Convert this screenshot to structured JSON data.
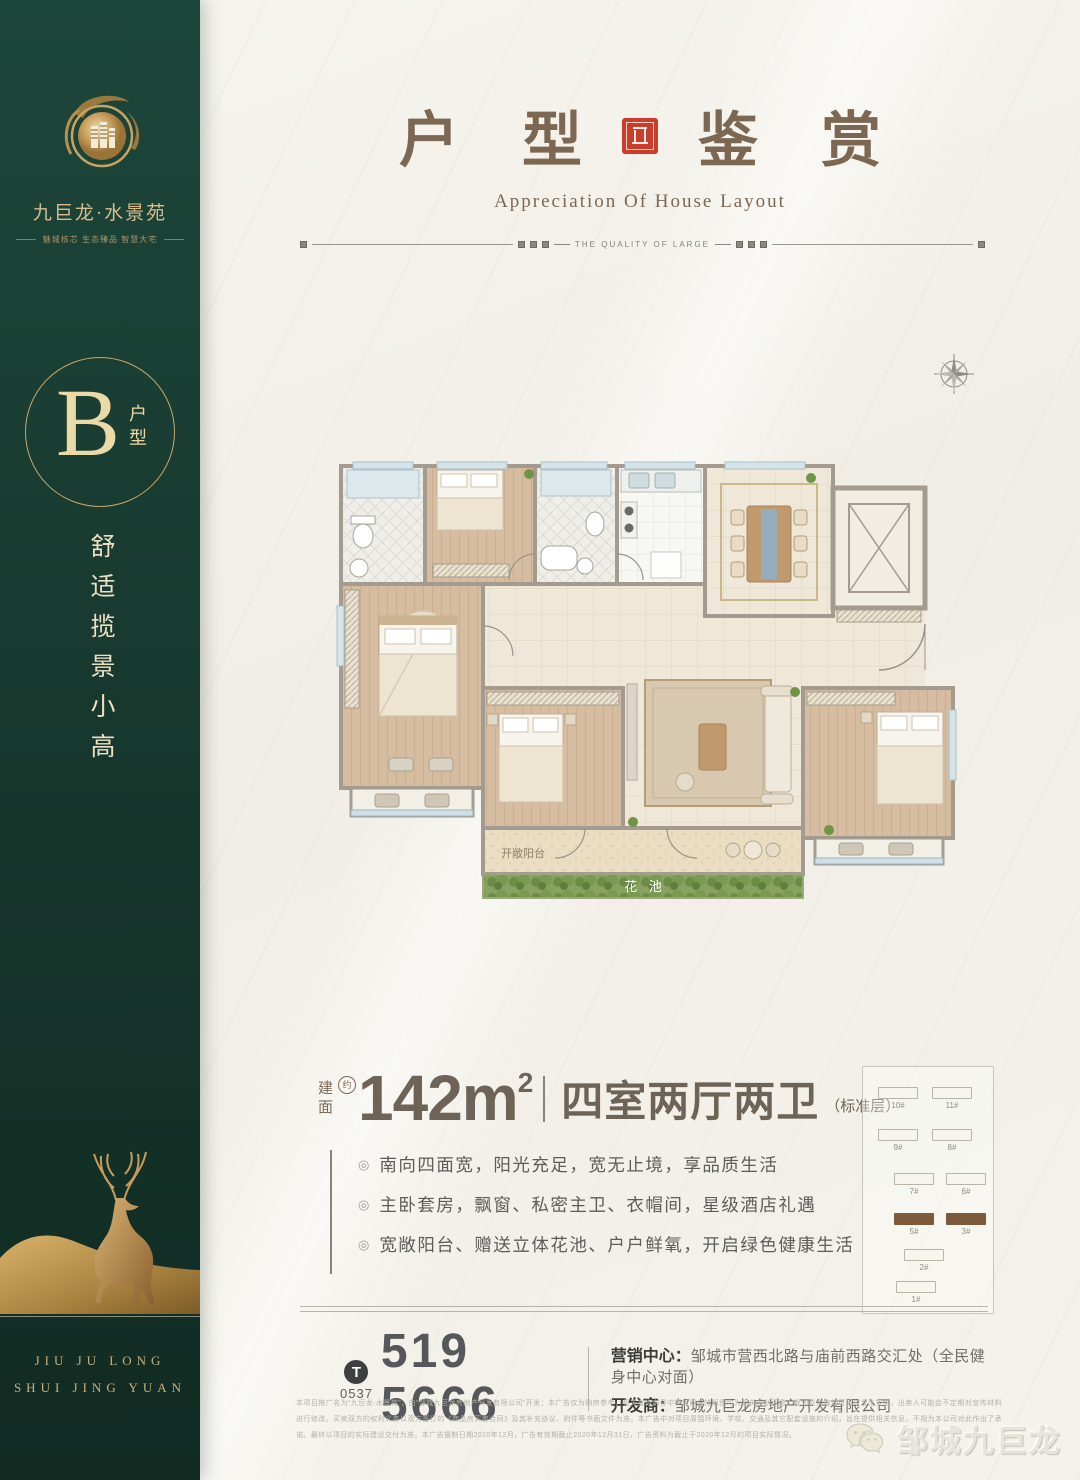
{
  "sidebar": {
    "brand_name": "九巨龙·水景苑",
    "brand_tagline": "魅城核芯 生态臻品 智慧大宅",
    "badge_letter": "B",
    "badge_suffix": "户型",
    "slogan": "舒适揽景小高",
    "footer_line1": "JIU JU LONG",
    "footer_line2": "SHUI JING YUAN"
  },
  "header": {
    "title_left": "户 型",
    "title_right": "鉴 赏",
    "subtitle": "Appreciation Of House Layout",
    "divider_text": "THE QUALITY OF LARGE"
  },
  "floorplan": {
    "balcony_label": "开敞阳台",
    "flowerbed_label": "花 池"
  },
  "spec": {
    "area_prefix_top": "建",
    "area_prefix_bottom": "面",
    "area_approx": "约",
    "area_value": "142m",
    "area_sup": "2",
    "layout_text": "四室两厅两卫",
    "layout_note": "（标准层）"
  },
  "features_marker": "◎",
  "features": [
    "南向四面宽，阳光充足，宽无止境，享品质生活",
    "主卧套房，飘窗、私密主卫、衣帽间，星级酒店礼遇",
    "宽敞阳台、赠送立体花池、户户鲜氧，开启绿色健康生活"
  ],
  "keyplan": {
    "items": [
      {
        "label": "10#"
      },
      {
        "label": "11#"
      },
      {
        "label": "9#"
      },
      {
        "label": "8#"
      },
      {
        "label": "7#"
      },
      {
        "label": "6#"
      },
      {
        "label": "5#"
      },
      {
        "label": "3#"
      },
      {
        "label": "2#"
      },
      {
        "label": "1#"
      }
    ]
  },
  "contact": {
    "phone_icon": "T",
    "area_code": "0537",
    "phone": "519 5666",
    "marketing_label": "营销中心：",
    "marketing_value": "邹城市营西北路与庙前西路交汇处（全民健身中心对面）",
    "developer_label": "开发商：",
    "developer_value": "邹城九巨龙房地产开发有限公司"
  },
  "disclaimer_text": "本项目推广名为“九巨龙·水景苑”，由“邹城九巨龙房地产开发有限公司”开发；本广告仅为购房参考，相关宣传内容中样板间与排版图均为相关规划示意，规划及实施均可因故发生变化，出卖人可能会不定期对宣传材料进行修改。买卖双方的权利义务以双方签订的《商品房买卖合同》及其补充协议、附件等书面文件为准。本广告中对项目周围环境、学校、交通及其它配套设施的介绍，旨在提供相关信息，不视为本公司对此作出了承诺。最终以项目的实际建设交付为准。本广告摄制日期2020年12月，广告有效期截止2020年12月31日，广告资料为截止于2020年12月的项目实际情况。",
  "wechat": {
    "name": "邹城九巨龙"
  }
}
